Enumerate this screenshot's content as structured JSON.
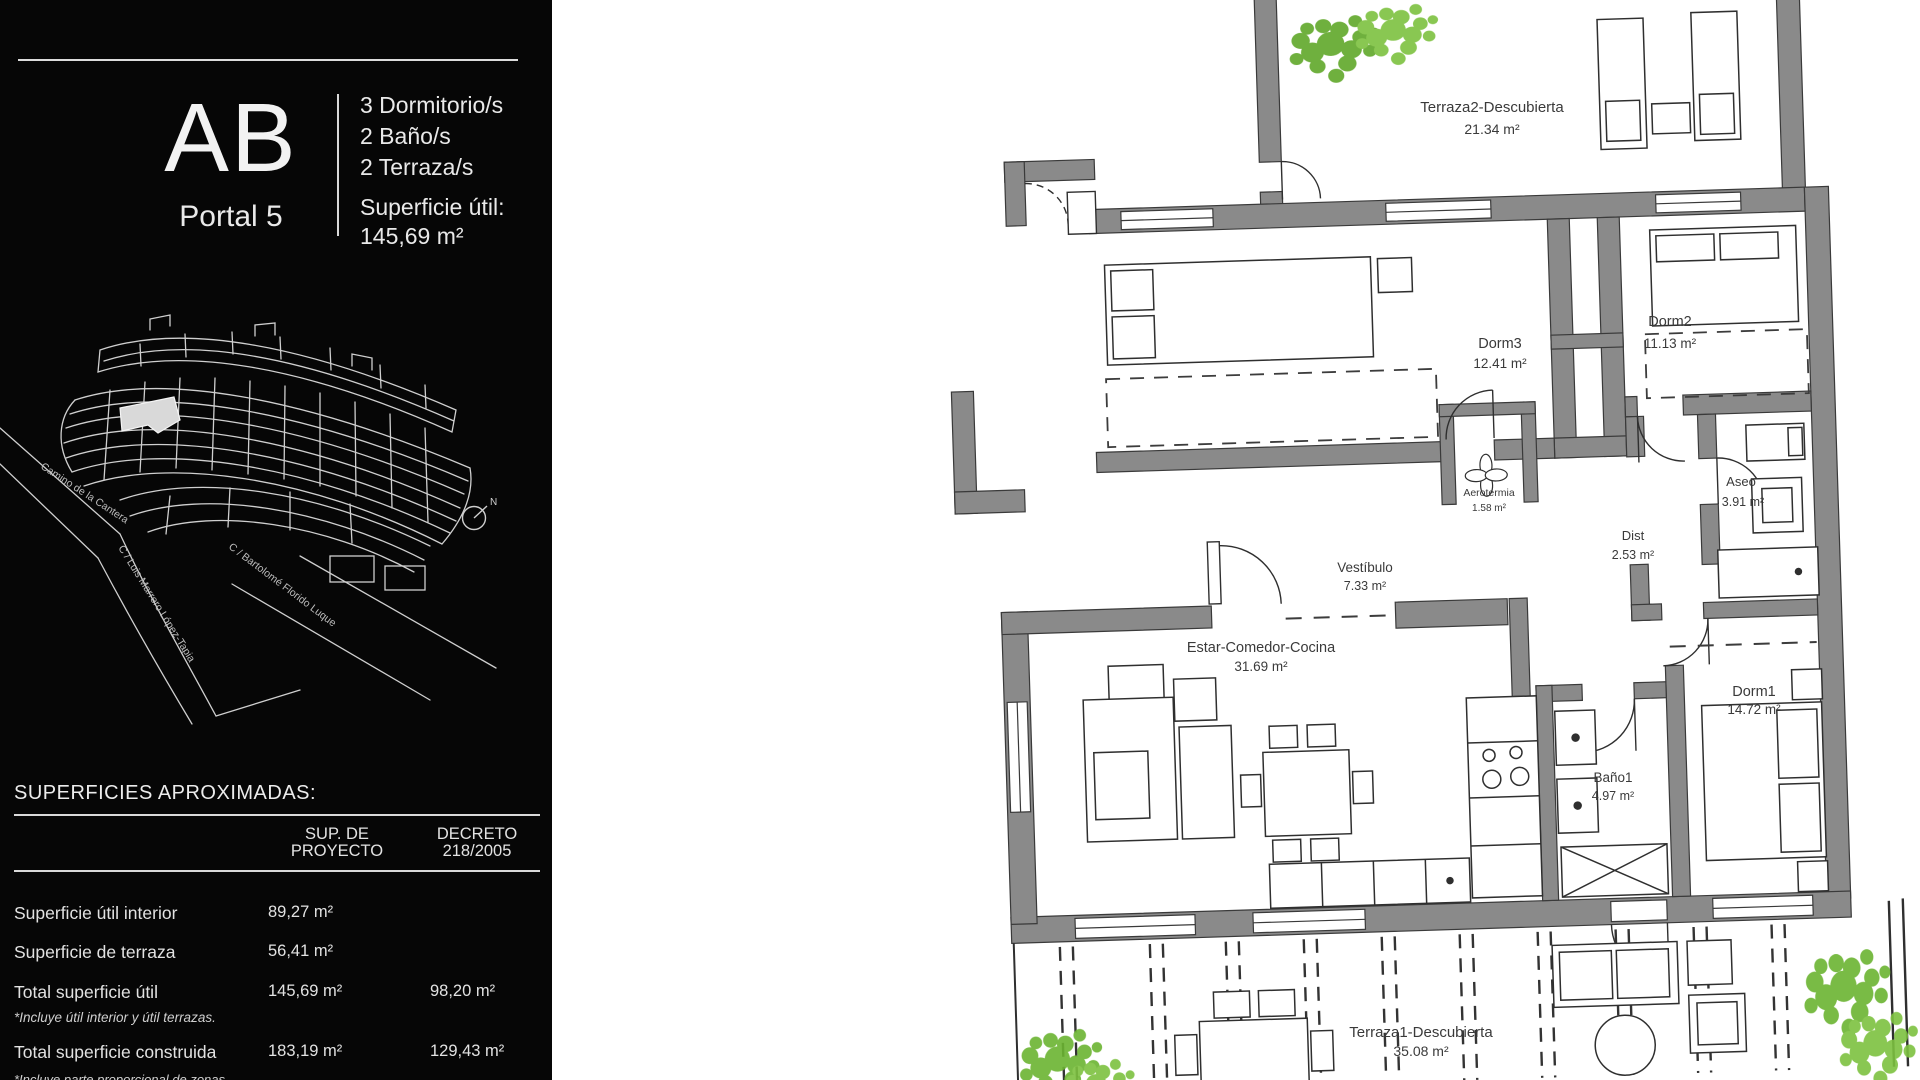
{
  "sidebar": {
    "unit_code": "AB",
    "portal": "Portal 5",
    "specs": [
      "3 Dormitorio/s",
      "2 Baño/s",
      "2 Terraza/s"
    ],
    "superficie_label": "Superficie útil:",
    "superficie_value": "145,69 m²",
    "site": {
      "streets": [
        "Camino de la Cantera",
        "C / Luis Marrero López-Tapia",
        "C / Bartolomé Florido Luque"
      ],
      "north": "N"
    },
    "table": {
      "title": "SUPERFICIES APROXIMADAS:",
      "col_proyecto": "SUP. DE\nPROYECTO",
      "col_decreto": "DECRETO\n218/2005",
      "rows": [
        {
          "label": "Superficie útil interior",
          "proyecto": "89,27  m²",
          "decreto": ""
        },
        {
          "label": "Superficie de terraza",
          "proyecto": "56,41 m²",
          "decreto": ""
        },
        {
          "label": "Total superficie útil",
          "proyecto": "145,69 m²",
          "decreto": "98,20 m²"
        },
        {
          "label": "Total superficie construida",
          "proyecto": "183,19 m²",
          "decreto": "129,43 m²"
        }
      ],
      "note_total_util": "*Incluye útil interior y útil terrazas.",
      "note_construida": "*Incluye parte proporcional de zonas comunes."
    }
  },
  "floorplan": {
    "rooms": [
      {
        "name": "Terraza2-Descubierta",
        "area": "21.34 m²"
      },
      {
        "name": "Dorm3",
        "area": "12.41 m²"
      },
      {
        "name": "Dorm2",
        "area": "11.13 m²"
      },
      {
        "name": "Aseo",
        "area": "3.91 m²"
      },
      {
        "name": "Aerotermia",
        "area": "1.58 m²"
      },
      {
        "name": "Dist",
        "area": "2.53 m²"
      },
      {
        "name": "Vestíbulo",
        "area": "7.33 m²"
      },
      {
        "name": "Estar-Comedor-Cocina",
        "area": "31.69 m²"
      },
      {
        "name": "Baño1",
        "area": "4.97 m²"
      },
      {
        "name": "Dorm1",
        "area": "14.72 m²"
      },
      {
        "name": "Terraza1-Descubierta",
        "area": "35.08 m²"
      }
    ],
    "colors": {
      "wall": "#8a8a8a",
      "line": "#2f2f2f",
      "foliage": "#6ab32f",
      "highlight_unit": "#d9d9d9"
    }
  }
}
